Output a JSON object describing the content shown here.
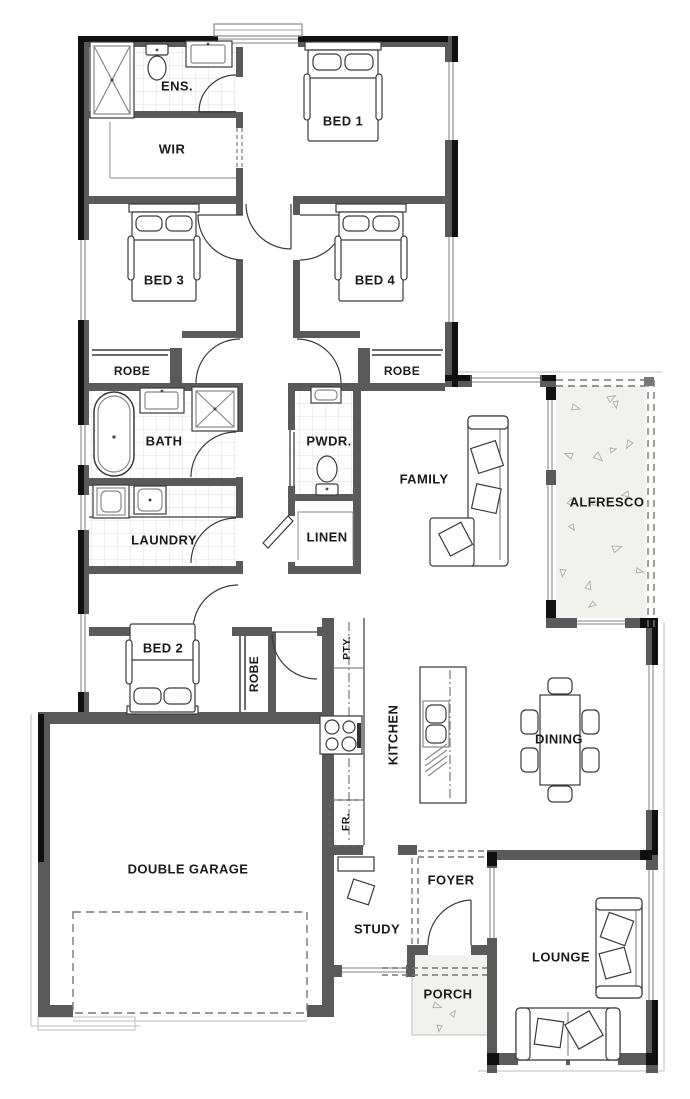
{
  "rooms": {
    "ens": {
      "label": "ENS."
    },
    "wir": {
      "label": "WIR"
    },
    "bed1": {
      "label": "BED 1"
    },
    "bed3": {
      "label": "BED 3"
    },
    "bed4": {
      "label": "BED 4"
    },
    "robe_bed3": {
      "label": "ROBE"
    },
    "robe_bed4": {
      "label": "ROBE"
    },
    "bath": {
      "label": "BATH"
    },
    "powder": {
      "label": "PWDR."
    },
    "family": {
      "label": "FAMILY"
    },
    "alfresco": {
      "label": "ALFRESCO"
    },
    "laundry": {
      "label": "LAUNDRY"
    },
    "linen": {
      "label": "LINEN"
    },
    "bed2": {
      "label": "BED 2"
    },
    "robe_bed2": {
      "label": "ROBE"
    },
    "pantry": {
      "label": "PTY."
    },
    "kitchen": {
      "label": "KITCHEN"
    },
    "fridge": {
      "label": "FR."
    },
    "dining": {
      "label": "DINING"
    },
    "garage": {
      "label": "DOUBLE GARAGE"
    },
    "study": {
      "label": "STUDY"
    },
    "foyer": {
      "label": "FOYER"
    },
    "porch": {
      "label": "PORCH"
    },
    "lounge": {
      "label": "LOUNGE"
    }
  },
  "colors": {
    "wall": "#5a5a5a",
    "exterior": "#101010",
    "concrete": "#f1f1ee",
    "tile": "#e2e2e0",
    "line": "#3a3a3a",
    "label": "#1b1b1b",
    "glass": "#9a9a9a",
    "dash": "#777777",
    "eave": "#c9c9c6"
  }
}
